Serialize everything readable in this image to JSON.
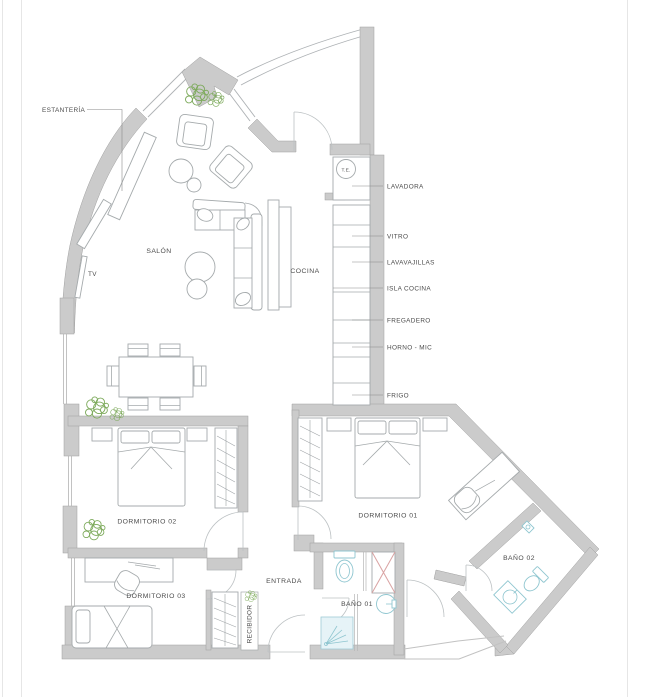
{
  "plan": {
    "rooms": {
      "salon": "SALÓN",
      "cocina": "COCINA",
      "dormitorio_01": "DORMITORIO 01",
      "dormitorio_02": "DORMITORIO 02",
      "dormitorio_03": "DORMITORIO 03",
      "bano_01": "BAÑO 01",
      "bano_02": "BAÑO 02",
      "entrada": "ENTRADA",
      "recibidor": "RECIBIDOR"
    },
    "callouts": {
      "estanteria": "ESTANTERÍA",
      "tv": "TV",
      "te": "T.E."
    },
    "kitchen_callouts": [
      "LAVADORA",
      "VITRO",
      "LAVAVAJILLAS",
      "ISLA COCINA",
      "FREGADERO",
      "HORNO - MIC",
      "FRIGO"
    ]
  },
  "colors": {
    "wall_fill": "#cbcbcb",
    "wall_edge": "#a0a0a0",
    "furniture_line": "#a5aaac",
    "label_text": "#4c4c4c",
    "plant_green": "#7daa5b",
    "bath_fixture": "#8fc6d0",
    "shower_fill": "#e6f3f7",
    "cross_accent": "#d9a3a3",
    "door_arc": "#bcc1c3"
  }
}
